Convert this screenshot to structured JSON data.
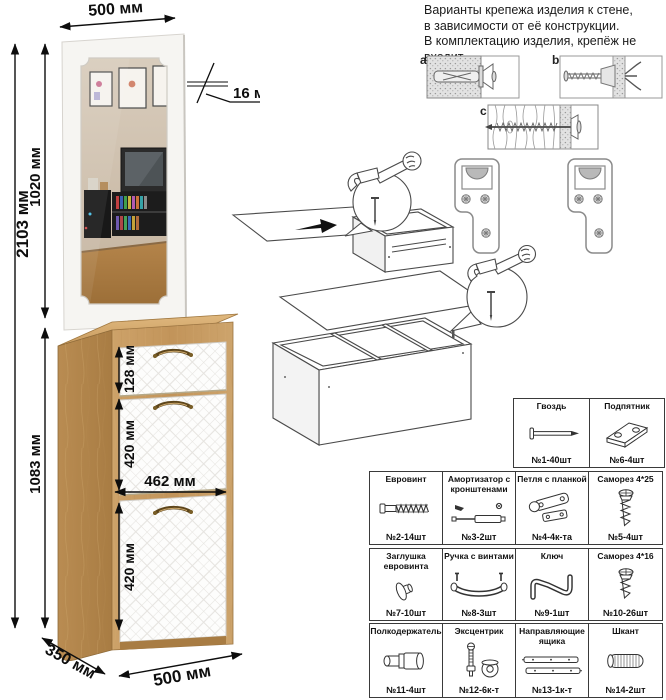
{
  "note": {
    "line1": "Варианты крепежа изделия к стене,",
    "line2": "в зависимости от её конструкции.",
    "line3": "В комплектацию изделия, крепёж не",
    "line4": "входит."
  },
  "fasteners": {
    "a": "a",
    "b": "b",
    "c": "c"
  },
  "dimensions": {
    "width_top": "500 мм",
    "thickness": "16 мм",
    "mirror_height": "1020 мм",
    "total_height": "2103 мм",
    "cabinet_height": "1083 мм",
    "drawer_height": "128 мм",
    "flap1_height": "420 мм",
    "front_width": "462 мм",
    "flap2_height": "420 мм",
    "depth": "350 мм",
    "width_bottom": "500 мм"
  },
  "parts": {
    "row1": [
      {
        "name": "Гвоздь",
        "count": "№1-40шт"
      },
      {
        "name": "Подпятник",
        "count": "№6-4шт"
      }
    ],
    "row2": [
      {
        "name": "Евровинт",
        "count": "№2-14шт"
      },
      {
        "name": "Амортизатор с кронштенами",
        "count": "№3-2шт"
      },
      {
        "name": "Петля с планкой",
        "count": "№4-4к-та"
      },
      {
        "name": "Саморез 4*25",
        "count": "№5-4шт"
      }
    ],
    "row3": [
      {
        "name": "Заглушка евровинта",
        "count": "№7-10шт"
      },
      {
        "name": "Ручка с винтами",
        "count": "№8-3шт"
      },
      {
        "name": "Ключ",
        "count": "№9-1шт"
      },
      {
        "name": "Саморез 4*16",
        "count": "№10-26шт"
      }
    ],
    "row4": [
      {
        "name": "Полкодержатель",
        "count": "№11-4шт"
      },
      {
        "name": "Эксцентрик",
        "count": "№12-6к-т"
      },
      {
        "name": "Направляющие ящика",
        "count": "№13-1к-т"
      },
      {
        "name": "Шкант",
        "count": "№14-2шт"
      }
    ]
  },
  "colors": {
    "wood": "#c79a5f",
    "wood_dark": "#a97f45",
    "front_white": "#fcfcfc",
    "quilt_line": "#e6e4e0",
    "handle_bronze": "#5d451a"
  }
}
